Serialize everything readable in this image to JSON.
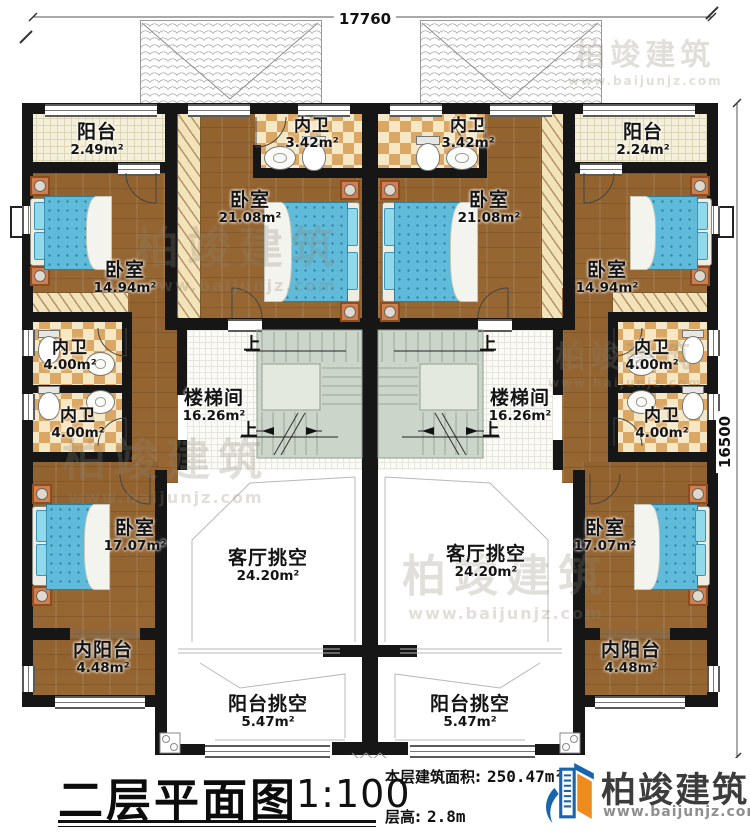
{
  "dimensions": {
    "top": "17760",
    "right": "16500"
  },
  "stairs": {
    "up": "上"
  },
  "rooms": {
    "balcony_l": {
      "name": "阳台",
      "area": "2.49m²"
    },
    "bath_top_l": {
      "name": "内卫",
      "area": "3.42m²"
    },
    "master_l": {
      "name": "卧室",
      "area": "21.08m²"
    },
    "bedroom1_l": {
      "name": "卧室",
      "area": "14.94m²"
    },
    "bath1_l": {
      "name": "内卫",
      "area": "4.00m²"
    },
    "bath2_l": {
      "name": "内卫",
      "area": "4.00m²"
    },
    "stair_l": {
      "name": "楼梯间",
      "area": "16.26m²"
    },
    "bedroom2_l": {
      "name": "卧室",
      "area": "17.07m²"
    },
    "living_void_l": {
      "name": "客厅挑空",
      "area": "24.20m²"
    },
    "inner_balcony_l": {
      "name": "内阳台",
      "area": "4.48m²"
    },
    "balcony_void_l": {
      "name": "阳台挑空",
      "area": "5.47m²"
    },
    "balcony_r": {
      "name": "阳台",
      "area": "2.24m²"
    },
    "bath_top_r": {
      "name": "内卫",
      "area": "3.42m²"
    },
    "master_r": {
      "name": "卧室",
      "area": "21.08m²"
    },
    "bedroom1_r": {
      "name": "卧室",
      "area": "14.94m²"
    },
    "bath1_r": {
      "name": "内卫",
      "area": "4.00m²"
    },
    "bath2_r": {
      "name": "内卫",
      "area": "4.00m²"
    },
    "stair_r": {
      "name": "楼梯间",
      "area": "16.26m²"
    },
    "bedroom2_r": {
      "name": "卧室",
      "area": "17.07m²"
    },
    "living_void_r": {
      "name": "客厅挑空",
      "area": "24.20m²"
    },
    "inner_balcony_r": {
      "name": "内阳台",
      "area": "4.48m²"
    },
    "balcony_void_r": {
      "name": "阳台挑空",
      "area": "5.47m²"
    }
  },
  "titleblock": {
    "title": "二层平面图",
    "scale": "1:100",
    "area_label": "本层建筑面积:",
    "area_value": "250.47m²",
    "height_label": "层高:",
    "height_value": "2.8m"
  },
  "brand": {
    "name": "柏竣建筑",
    "url": "www.baijunjz.com"
  },
  "watermark": {
    "name": "柏竣建筑",
    "url": "www.baijunjz.com"
  }
}
